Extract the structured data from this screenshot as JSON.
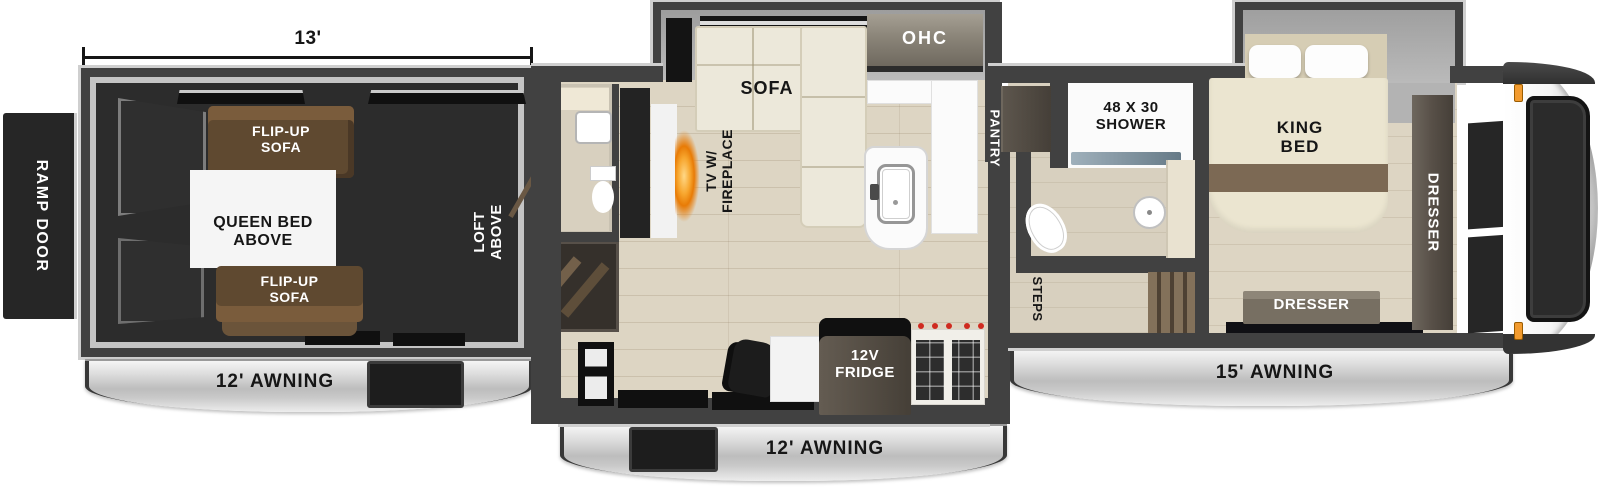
{
  "garage": {
    "dim": "13'",
    "ramp_door": "RAMP DOOR",
    "flip_sofa_top": "FLIP-UP\nSOFA",
    "queen_bed": "QUEEN BED\nABOVE",
    "flip_sofa_bottom": "FLIP-UP\nSOFA",
    "loft": "LOFT\nABOVE",
    "awning": "12' AWNING"
  },
  "living": {
    "tv": "TV W/\nFIREPLACE",
    "sofa": "SOFA",
    "ohc": "OHC",
    "pantry": "PANTRY",
    "fridge": "12V\nFRIDGE",
    "awning": "12' AWNING"
  },
  "bath": {
    "shower": "48 X 30\nSHOWER",
    "steps": "STEPS"
  },
  "bedroom": {
    "king_bed": "KING\nBED",
    "dresser_side": "DRESSER",
    "dresser_foot": "DRESSER",
    "awning": "15' AWNING"
  },
  "colors": {
    "wall": "#414141",
    "wall-trim": "#cfcfcf",
    "garage-floor": "#2c2c2c",
    "wood-floor": "#ddd5c3",
    "tile-floor": "#d8d0bf",
    "sofa-cream": "#ece8da",
    "sofa-brown": "#5f4930",
    "sofa-brown-lt": "#7a5c3c",
    "dark-wood": "#524b42",
    "bed-cream": "#ebe5d0",
    "bed-stripe": "#7c6954",
    "flame": "#f59d22",
    "knob-red": "#cf2b20",
    "marker-light": "#f29b2f"
  }
}
